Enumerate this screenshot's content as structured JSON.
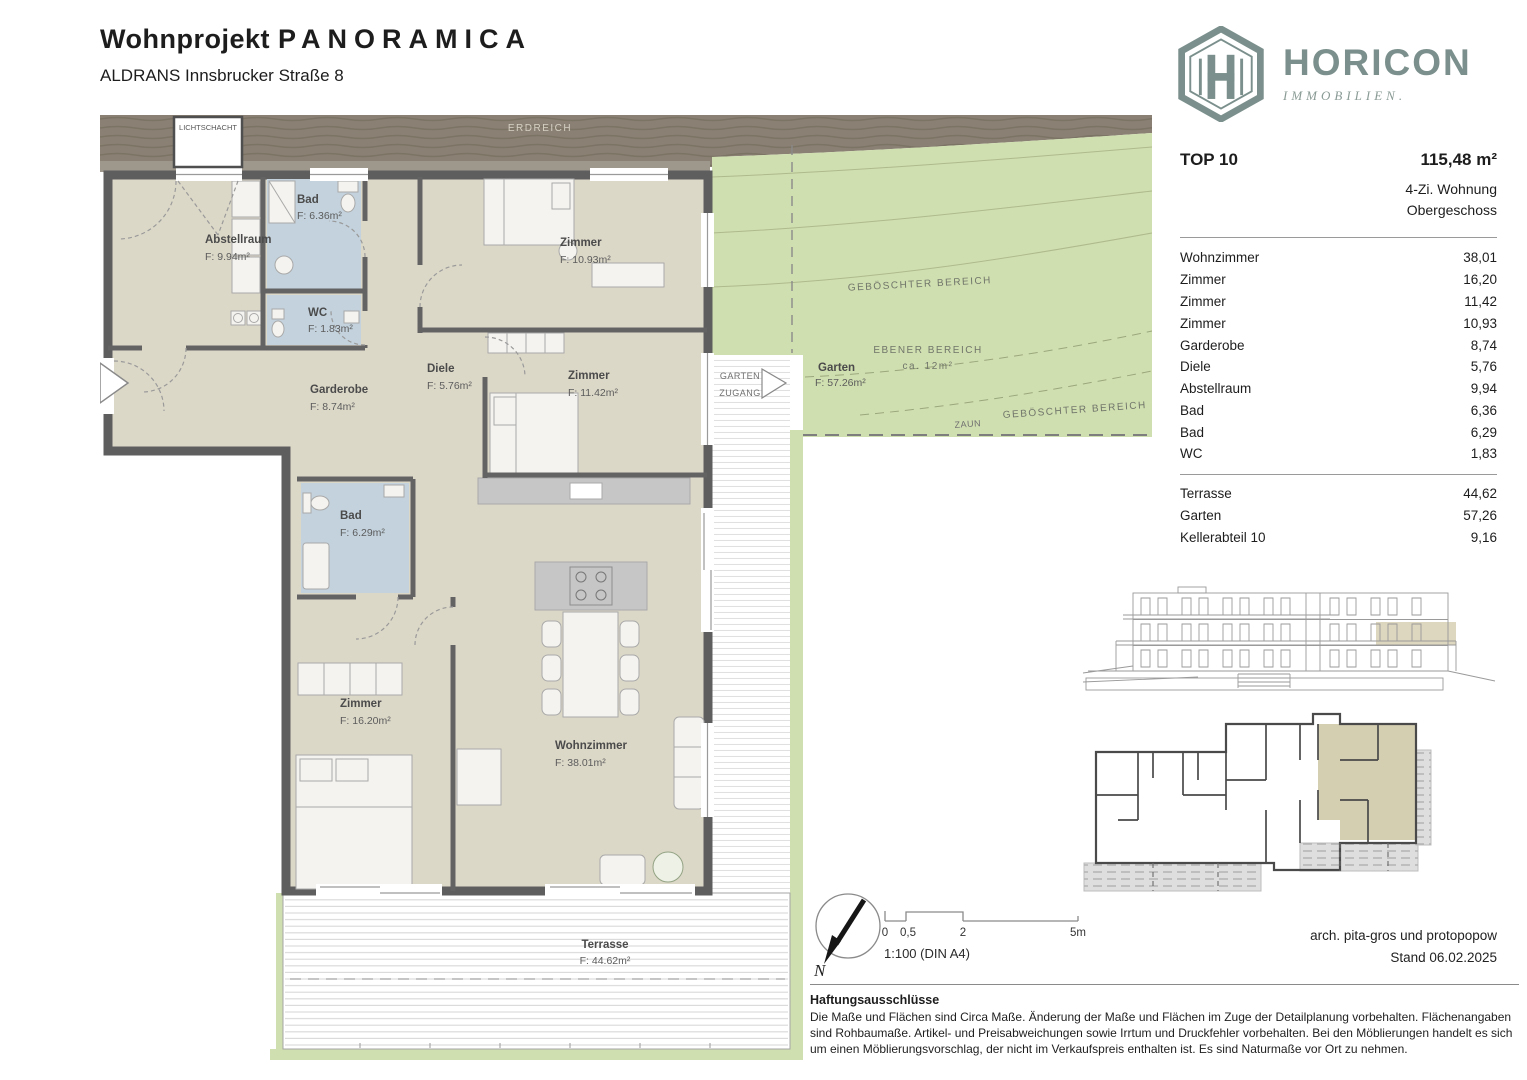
{
  "header": {
    "title_main": "Wohnprojekt",
    "title_name": "PANORAMICA",
    "subtitle": "ALDRANS Innsbrucker Straße 8"
  },
  "logo": {
    "brand": "HORICON",
    "tagline": "IMMOBILIEN.",
    "color": "#7b908c"
  },
  "unit": {
    "id": "TOP 10",
    "total_area": "115,48 m²",
    "type": "4-Zi. Wohnung",
    "floor": "Obergeschoss",
    "rooms": [
      {
        "label": "Wohnzimmer",
        "area": "38,01"
      },
      {
        "label": "Zimmer",
        "area": "16,20"
      },
      {
        "label": "Zimmer",
        "area": "11,42"
      },
      {
        "label": "Zimmer",
        "area": "10,93"
      },
      {
        "label": "Garderobe",
        "area": "8,74"
      },
      {
        "label": "Diele",
        "area": "5,76"
      },
      {
        "label": "Abstellraum",
        "area": "9,94"
      },
      {
        "label": "Bad",
        "area": "6,36"
      },
      {
        "label": "Bad",
        "area": "6,29"
      },
      {
        "label": "WC",
        "area": "1,83"
      }
    ],
    "outdoor": [
      {
        "label": "Terrasse",
        "area": "44,62"
      },
      {
        "label": "Garten",
        "area": "57,26"
      },
      {
        "label": "Kellerabteil 10",
        "area": "9,16"
      }
    ]
  },
  "plan": {
    "band_label": "ERDREICH",
    "lichtschacht": "LICHTSCHACHT",
    "rooms": {
      "abstellraum": {
        "name": "Abstellraum",
        "area": "F: 9.94m²"
      },
      "bad_og": {
        "name": "Bad",
        "area": "F: 6.36m²"
      },
      "wc": {
        "name": "WC",
        "area": "F: 1.83m²"
      },
      "zimmer_1093": {
        "name": "Zimmer",
        "area": "F: 10.93m²"
      },
      "zimmer_1142": {
        "name": "Zimmer",
        "area": "F: 11.42m²"
      },
      "diele": {
        "name": "Diele",
        "area": "F: 5.76m²"
      },
      "garderobe": {
        "name": "Garderobe",
        "area": "F: 8.74m²"
      },
      "bad_2": {
        "name": "Bad",
        "area": "F: 6.29m²"
      },
      "zimmer_1620": {
        "name": "Zimmer",
        "area": "F: 16.20m²"
      },
      "wohnzimmer": {
        "name": "Wohnzimmer",
        "area": "F: 38.01m²"
      },
      "terrasse": {
        "name": "Terrasse",
        "area": "F: 44.62m²"
      }
    },
    "garden": {
      "slope_label": "GEBÖSCHTER BEREICH",
      "slope_label_2": "GEBÖSCHTER BEREICH",
      "flat_label": "EBENER BEREICH",
      "flat_area": "ca. 12m²",
      "name": "Garten",
      "area": "F: 57.26m²",
      "fence": "ZAUN",
      "access_line1": "GARTEN",
      "access_line2": "ZUGANG"
    }
  },
  "footer": {
    "north": "N",
    "scale_ticks": [
      "0",
      "0,5",
      "2",
      "5m"
    ],
    "scale_note": "1:100 (DIN A4)",
    "architect": "arch. pita-gros und protopopow",
    "date": "Stand 06.02.2025",
    "disclaimer_title": "Haftungsausschlüsse",
    "disclaimer_text": "Die Maße und Flächen sind Circa Maße. Änderung der Maße und Flächen im Zuge der Detailplanung vorbehalten. Flächenangaben sind Rohbaumaße. Artikel- und Preisabweichungen sowie Irrtum und Druckfehler vorbehalten. Bei den Möblierungen handelt es sich um einen Möblierungsvorschlag, der nicht im Verkaufspreis enthalten ist. Es sind Naturmaße vor Ort zu nehmen."
  }
}
